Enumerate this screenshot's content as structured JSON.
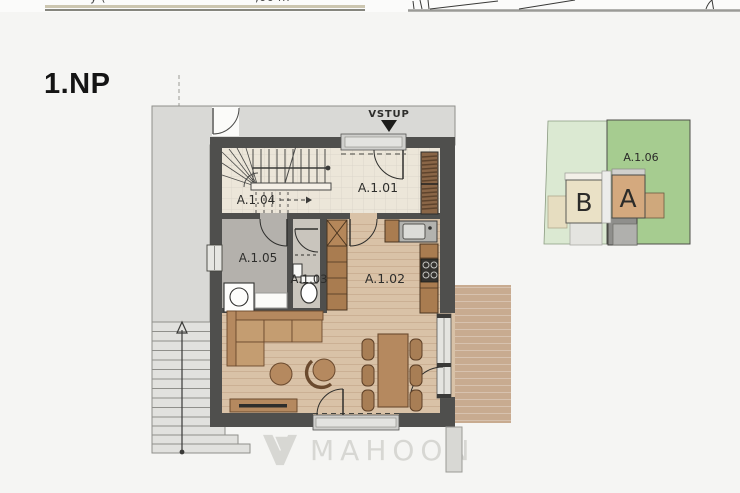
{
  "header": {
    "left_fragment": "y (",
    "right_fragment": ",00 m"
  },
  "title": "1.NP",
  "floorplan": {
    "entrance_label": "VSTUP",
    "rooms": [
      {
        "id": "A.1.01",
        "label": "A.1.01"
      },
      {
        "id": "A.1.02",
        "label": "A.1.02"
      },
      {
        "id": "A.1.03",
        "label": "A.1.03"
      },
      {
        "id": "A.1.04",
        "label": "A.1.04"
      },
      {
        "id": "A.1.05",
        "label": "A.1.05"
      }
    ],
    "icons": {
      "entrance_arrow": "triangle-down",
      "stairs_direction": "arrow-up"
    }
  },
  "siteplan": {
    "parcel_label": "A.1.06",
    "building_a_label": "A",
    "building_b_label": "B"
  },
  "watermark": {
    "text": "MAHOON"
  },
  "colors": {
    "background": "#f5f5f3",
    "wall": "#4f4f4d",
    "walkway": "#d9d9d6",
    "hall_floor": "#ece6d9",
    "wood_floor": "#d9c2a7",
    "tech_floor": "#b4b1ac",
    "wc_floor": "#c9c5bd",
    "terrace_deck": "#c8ab90",
    "furniture_wood": "#b5895f",
    "cushion_wood": "#c49d71",
    "cabinet_wood": "#a97c50",
    "wardrobe_wood": "#8a6647",
    "parcel_light_green": "#dbe9d2",
    "parcel_green": "#a6cc90",
    "building_a_fill": "#d4a97e",
    "building_b_fill": "#eae1c6",
    "watermark_gray": "#d7d7d3",
    "ink": "#141414"
  }
}
